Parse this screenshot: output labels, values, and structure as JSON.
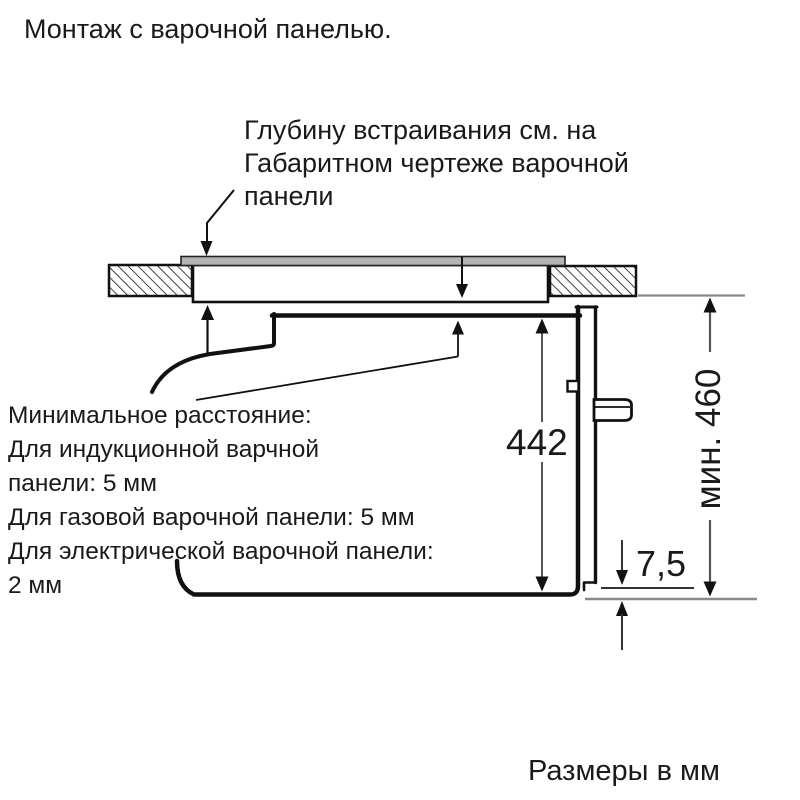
{
  "title": "Монтаж с варочной панелью.",
  "annotation": {
    "lines": [
      "Глубину встраивания см. на",
      "Габаритном чертеже варочной",
      "панели"
    ]
  },
  "min_distance": {
    "lines": [
      "Минимальное расстояние:",
      "Для индукционной варчной",
      "панели: 5 мм",
      "Для газовой варочной панели: 5 мм",
      "Для электрической варочной панели:",
      "2 мм"
    ]
  },
  "dimensions": {
    "appliance_height": "442",
    "niche_min_height": "мин. 460",
    "bottom_gap": "7,5"
  },
  "footer": {
    "units_note": "Размеры в мм"
  },
  "colors": {
    "outline": "#111111",
    "dimension_line": "#555555",
    "extension_line": "#8a8a8a",
    "hob_plate_fill": "#b4b4b4",
    "background": "#ffffff",
    "text": "#1a1a1a"
  }
}
